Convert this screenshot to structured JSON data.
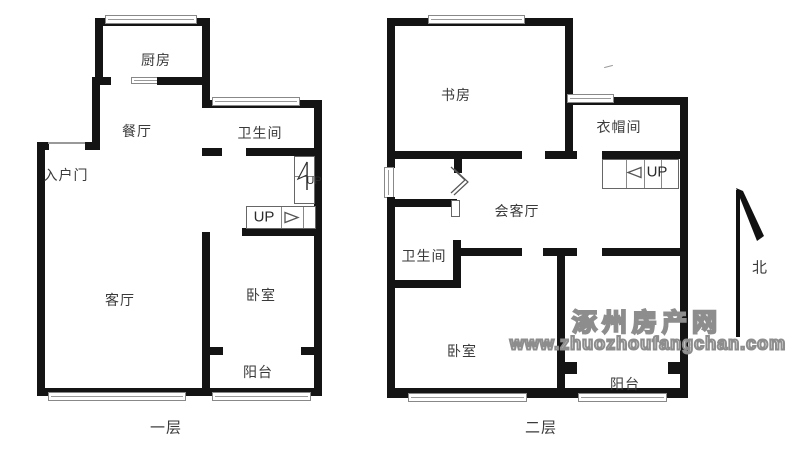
{
  "floor1": {
    "name": "一层",
    "rooms": {
      "kitchen": "厨房",
      "dining": "餐厅",
      "bathroom": "卫生间",
      "entry_door": "入户门",
      "living": "客厅",
      "bedroom": "卧室",
      "balcony": "阳台"
    },
    "stairs": {
      "up_main": "UP",
      "up_side": "UP"
    }
  },
  "floor2": {
    "name": "二层",
    "rooms": {
      "study": "书房",
      "cloakroom": "衣帽间",
      "reception": "会客厅",
      "bathroom": "卫生间",
      "bedroom": "卧室",
      "balcony": "阳台"
    },
    "stairs": {
      "up": "UP"
    }
  },
  "compass": {
    "north_label": "北"
  },
  "watermark": {
    "site_name": "涿州房产网",
    "site_url": "www.zhuozhoufangchan.com"
  },
  "colors": {
    "wall": "#141414",
    "window_line": "#888888",
    "label_text": "#3a3a3a",
    "watermark_gray": "#8d8d8d"
  }
}
